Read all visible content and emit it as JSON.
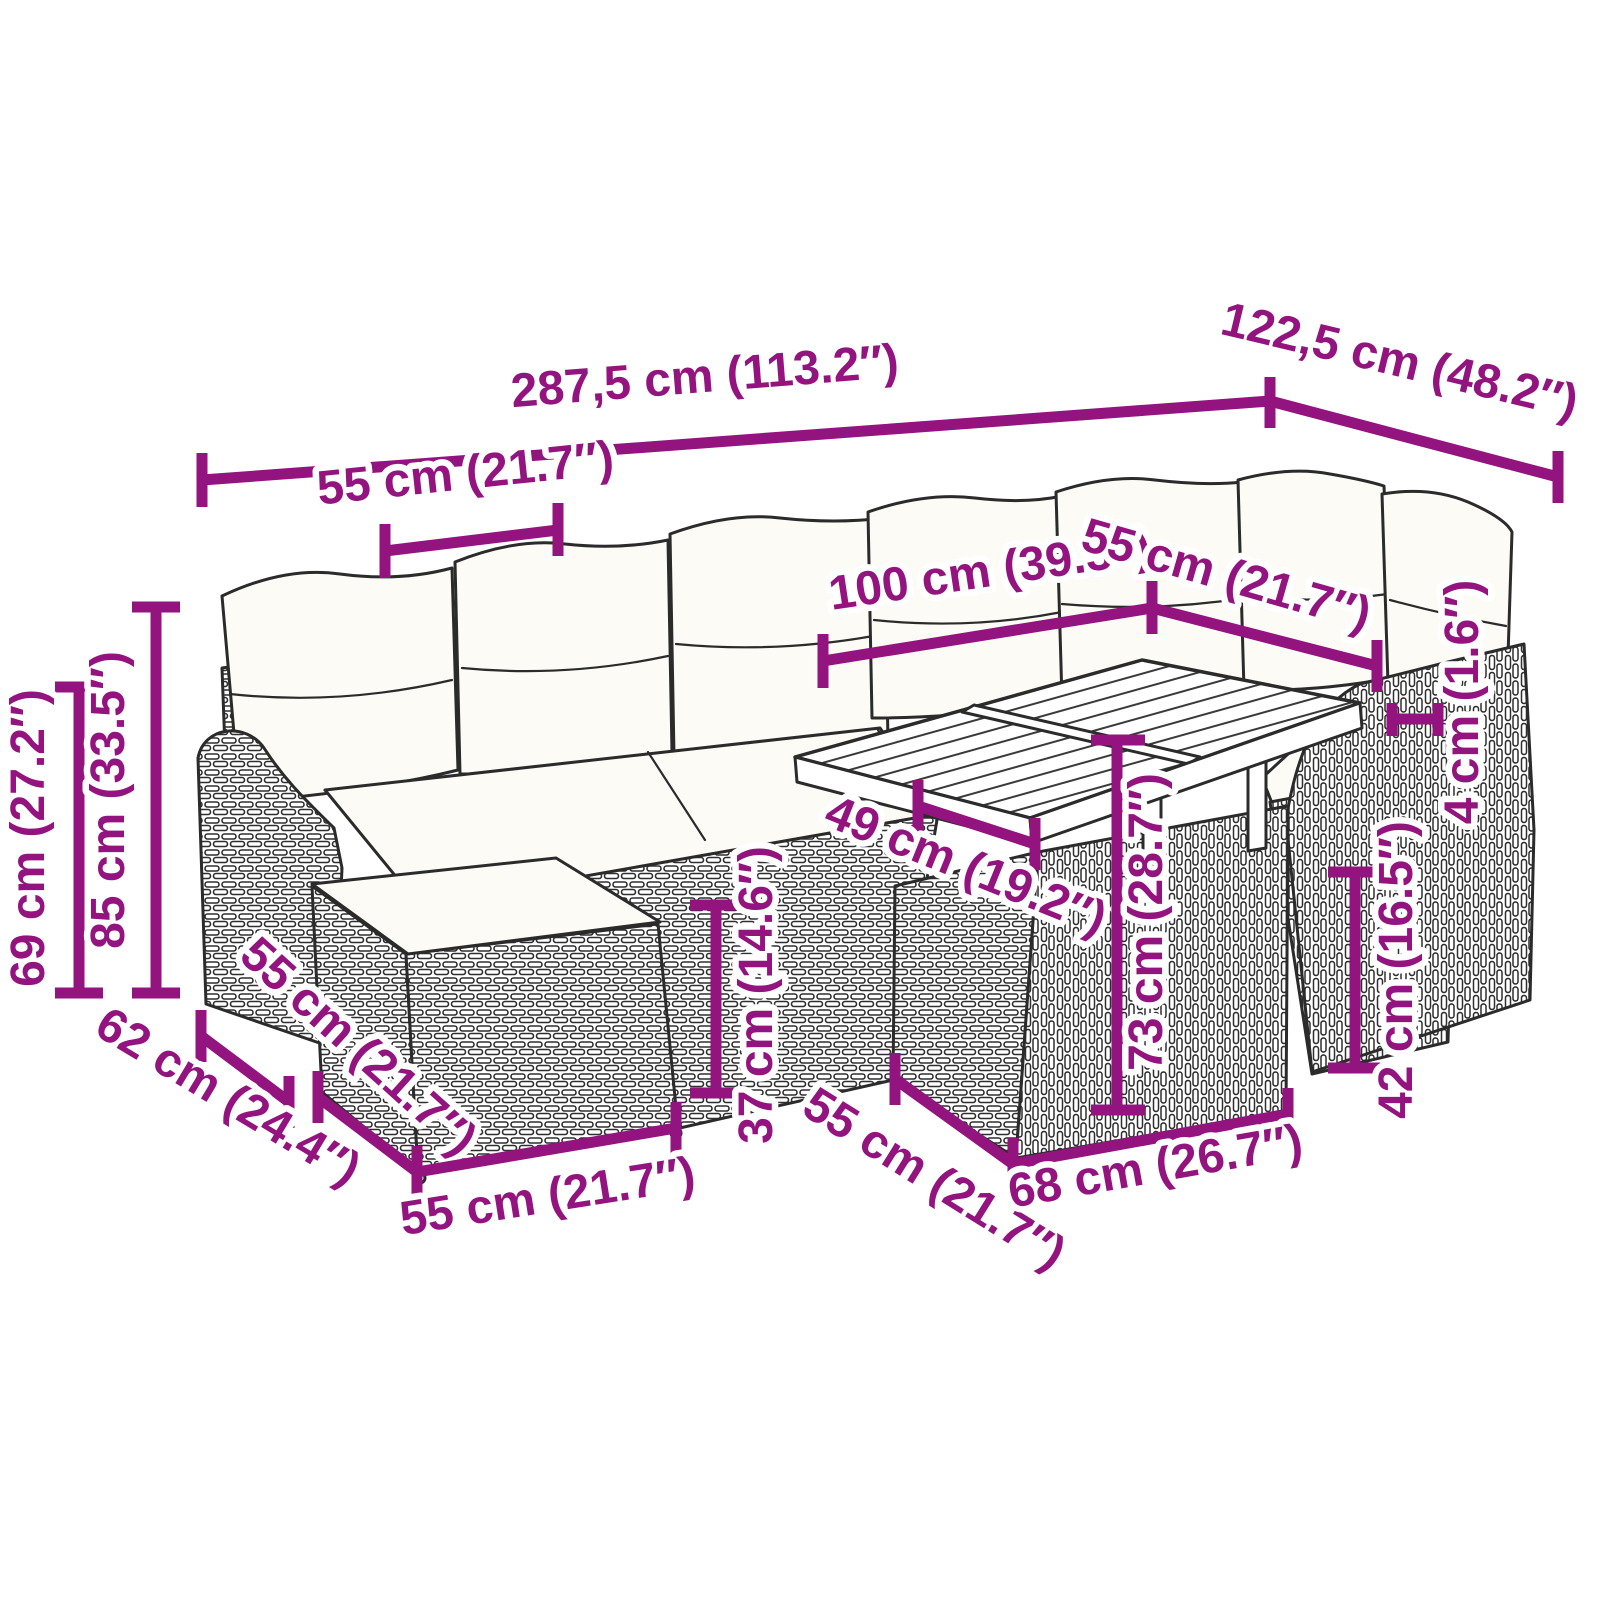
{
  "colors": {
    "dimension_accent": "#93137F",
    "line_art": "#2B2B2B",
    "background": "#FFFFFF"
  },
  "dimensions": {
    "overall_width": {
      "label": "287,5 cm (113.2″)",
      "cm": 287.5,
      "inches": 113.2
    },
    "overall_depth": {
      "label": "122,5 cm (48.2″)",
      "cm": 122.5,
      "inches": 48.2
    },
    "seat_module_width_top": {
      "label": "55 cm (21.7″)",
      "cm": 55,
      "inches": 21.7
    },
    "table_length": {
      "label": "100 cm (39.3″)",
      "cm": 100,
      "inches": 39.3
    },
    "seat_module_width_right": {
      "label": "55 cm (21.7″)",
      "cm": 55,
      "inches": 21.7
    },
    "armrest_height": {
      "label": "69 cm (27.2″)",
      "cm": 69,
      "inches": 27.2
    },
    "total_height": {
      "label": "85 cm (33.5″)",
      "cm": 85,
      "inches": 33.5
    },
    "seat_height": {
      "label": "37 cm (14.6″)",
      "cm": 37,
      "inches": 14.6
    },
    "table_clearance_width": {
      "label": "49 cm (19.2″)",
      "cm": 49,
      "inches": 19.2
    },
    "table_height": {
      "label": "73 cm (28.7″)",
      "cm": 73,
      "inches": 28.7
    },
    "table_base_height": {
      "label": "42 cm (16.5″)",
      "cm": 42,
      "inches": 16.5
    },
    "tabletop_thickness": {
      "label": "4 cm (1.6″)",
      "cm": 4,
      "inches": 1.6
    },
    "armrest_depth": {
      "label": "62 cm (24.4″)",
      "cm": 62,
      "inches": 24.4
    },
    "ottoman_depth": {
      "label": "55 cm (21.7″)",
      "cm": 55,
      "inches": 21.7
    },
    "ottoman_width": {
      "label": "55 cm (21.7″)",
      "cm": 55,
      "inches": 21.7
    },
    "table_front_depth": {
      "label": "55 cm (21.7″)",
      "cm": 55,
      "inches": 21.7
    },
    "table_base_width": {
      "label": "68 cm (26.7″)",
      "cm": 68,
      "inches": 26.7
    }
  }
}
